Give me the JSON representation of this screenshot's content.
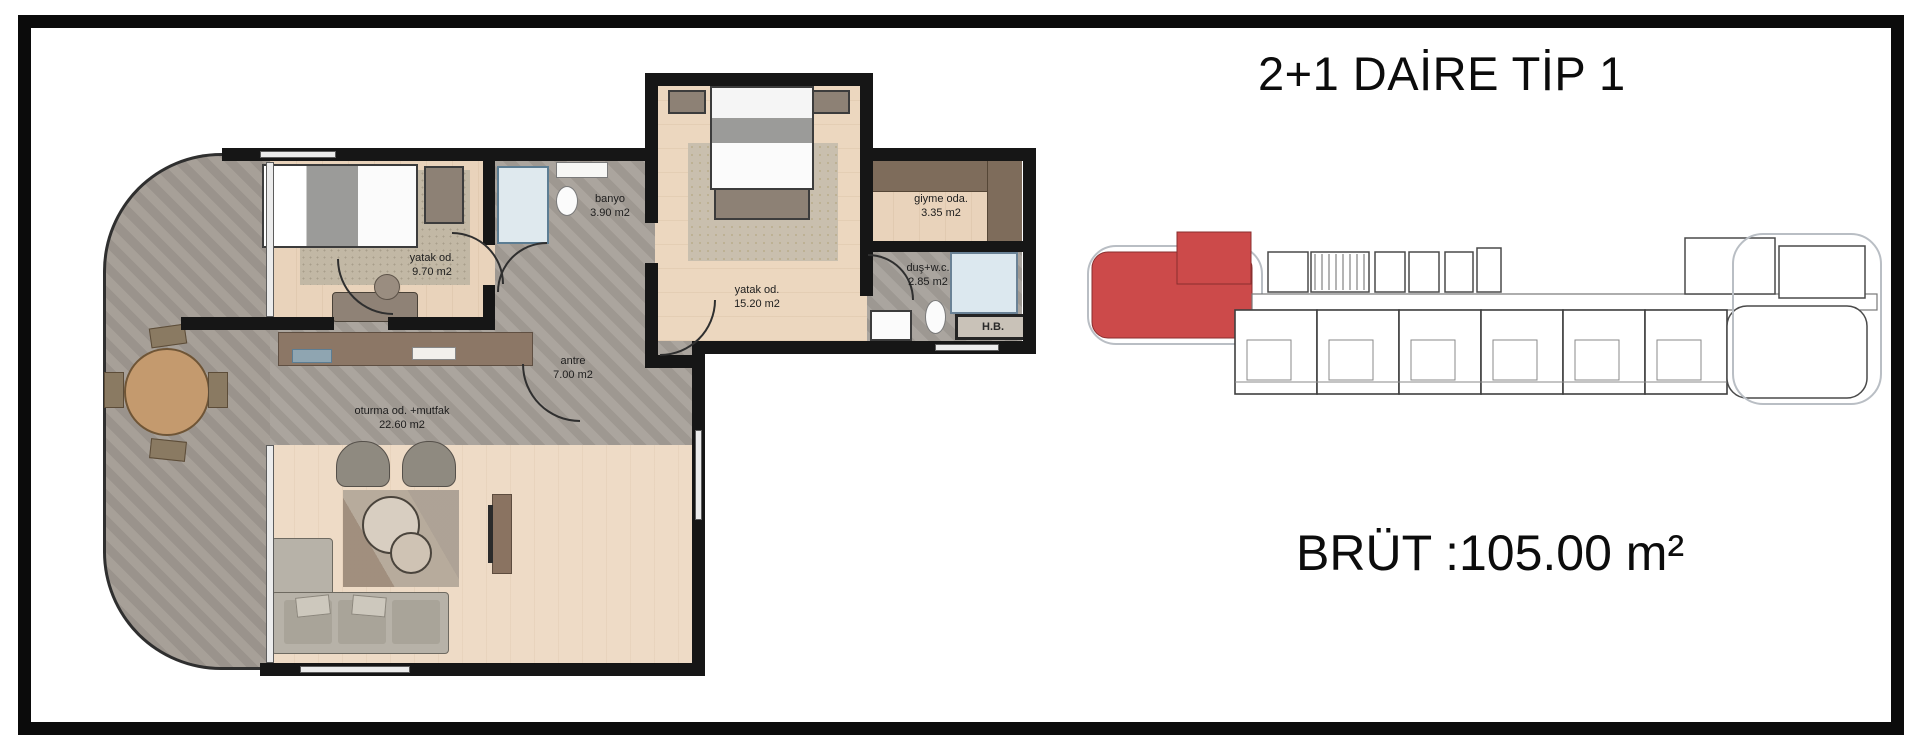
{
  "header": {
    "title": "2+1 DAİRE TİP 1"
  },
  "summary": {
    "gross_area_label": "BRÜT :105.00 m²"
  },
  "floor_plan": {
    "rooms": [
      {
        "name": "yatak-odasi-1",
        "label": "yatak od.",
        "area": "9.70 m2"
      },
      {
        "name": "banyo",
        "label": "banyo",
        "area": "3.90 m2"
      },
      {
        "name": "giyinme-odasi",
        "label": "giyme oda.",
        "area": "3.35 m2"
      },
      {
        "name": "yatak-odasi-2",
        "label": "yatak od.",
        "area": "15.20 m2"
      },
      {
        "name": "dus-wc",
        "label": "duş+w.c.",
        "area": "2.85 m2"
      },
      {
        "name": "antre",
        "label": "antre",
        "area": "7.00 m2"
      },
      {
        "name": "oturma-mutfak",
        "label": "oturma od. +mutfak",
        "area": "22.60 m2"
      },
      {
        "name": "hb",
        "label": "H.B.",
        "area": ""
      }
    ]
  },
  "key_plan": {
    "highlight_color": "#cc4a4a",
    "outline_color": "#b9bec4",
    "wall_color": "#4a4a4a"
  },
  "colors": {
    "wall": "#161616",
    "wood": "#e9d3bb",
    "stone": "#a7a099",
    "terrace": "#a39c94",
    "accent_red": "#cc4a4a"
  }
}
